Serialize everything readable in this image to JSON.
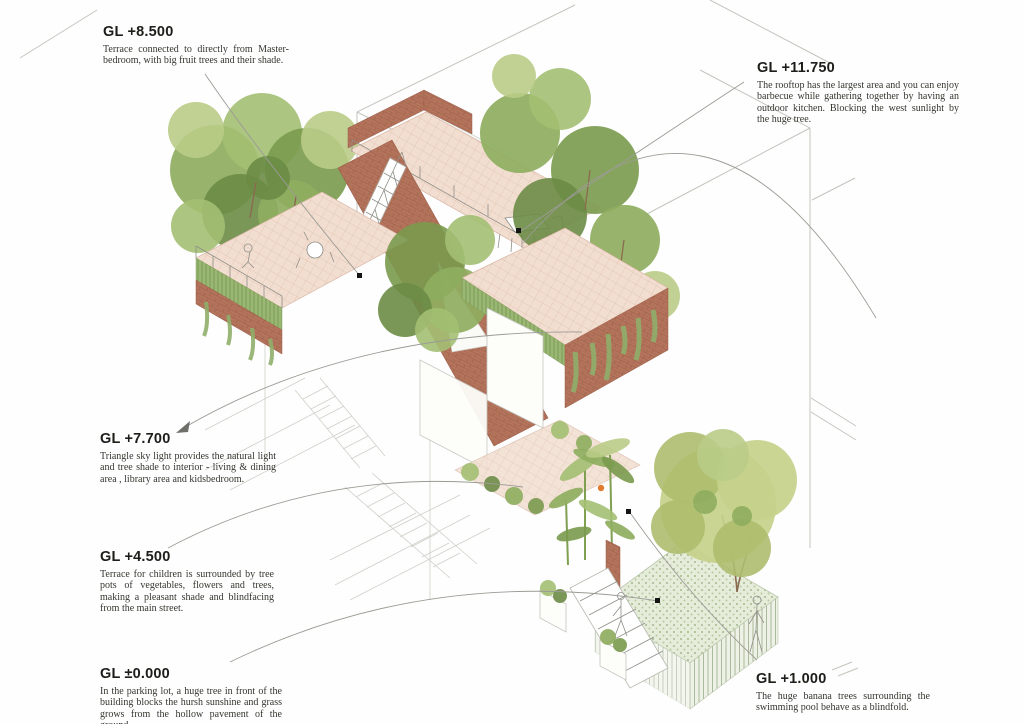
{
  "drawing_title": "Axonometric section of a terraced house with trees",
  "annotations": [
    {
      "id": "gl-8500",
      "level": "GL +8.500",
      "text": "Terrace connected to directly from Master-bedroom, with big fruit trees and their shade."
    },
    {
      "id": "gl-11750",
      "level": "GL +11.750",
      "text": "The rooftop has the largest area and you can enjoy barbecue while gathering together by having an outdoor kitchen. Blocking the west sunlight by the huge tree."
    },
    {
      "id": "gl-7700",
      "level": "GL +7.700",
      "text": "Triangle sky light provides the natural light and tree shade to interior - living & dining area , library area and kidsbedroom."
    },
    {
      "id": "gl-4500",
      "level": "GL +4.500",
      "text": "Terrace for children is surrounded by tree pots of vegetables, flowers and trees, making a pleasant shade and blindfacing from the main street."
    },
    {
      "id": "gl-0000",
      "level": "GL ±0.000",
      "text": "In the parking lot, a huge tree in front of the building blocks the hursh sunshine and grass grows from the hollow pavement of the ground."
    },
    {
      "id": "gl-1000",
      "level": "GL +1.000",
      "text": "The huge banana trees surrounding the swimming pool behave as a blindfold."
    }
  ],
  "colors": {
    "paper": "#fefefe",
    "brick": "#b4745c",
    "brick_line": "#9c5e49",
    "terrace_tile": "#f2ded0",
    "tile_line": "#e0c0ae",
    "foliage_dark": "#6b8c46",
    "foliage_mid": "#8fae60",
    "foliage_light": "#b9cc87",
    "pool_deck": "#e6ecda",
    "hatch_green": "#a9b99b",
    "wireframe_gray": "#c4c4be",
    "leader_gray": "#9b9b95",
    "text_dark": "#1d1d1a"
  }
}
